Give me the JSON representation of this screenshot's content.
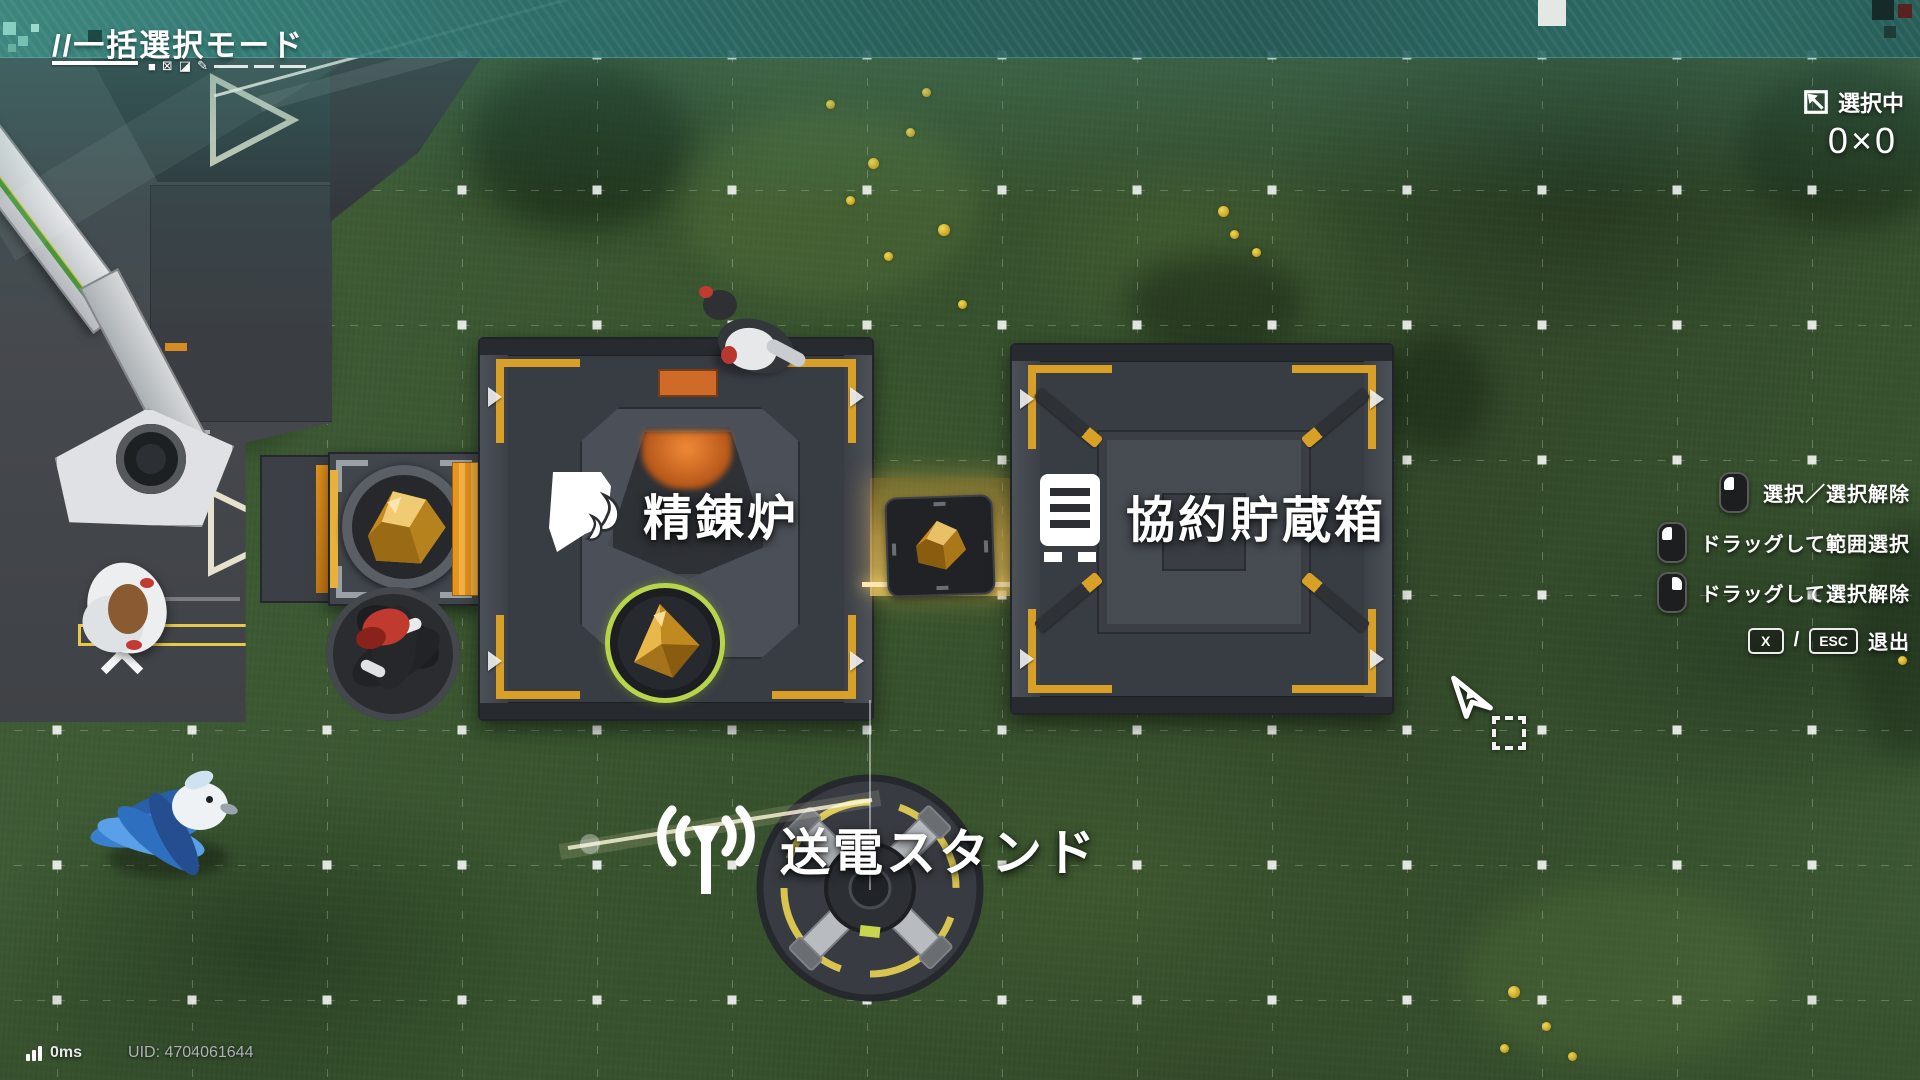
{
  "header": {
    "mode_title": "//一括選択モード"
  },
  "selection_status": {
    "label": "選択中",
    "count": "0×0"
  },
  "building_labels": {
    "refinery": "精錬炉",
    "storage": "協約貯蔵箱",
    "power_stand": "送電スタンド"
  },
  "hints": {
    "items": [
      {
        "device": "mouse-left",
        "label": "選択／選択解除"
      },
      {
        "device": "mouse-left-drag",
        "label": "ドラッグして範囲選択"
      },
      {
        "device": "mouse-right-drag",
        "label": "ドラッグして選択解除"
      }
    ],
    "exit": {
      "key1": "X",
      "separator": "/",
      "key2": "ESC",
      "label": "退出"
    }
  },
  "status_bar": {
    "ping": "0ms",
    "uid": "UID: 4704061644"
  },
  "icons": {
    "mode_filled_square": "■",
    "mode_checked_square": "⊠",
    "mode_half_square": "◪",
    "mode_edit_pencil": "✎",
    "selection_area_icon": "expand-arrow-square",
    "mouse_left_icon": "mouse-left-button",
    "mouse_right_icon": "mouse-right-button",
    "signal_icon": "signal-bars",
    "refinery_icon": "flame-sheet",
    "storage_icon": "ledger-box",
    "power_icon": "antenna-broadcast",
    "cursor_icon": "pointer-arrow"
  },
  "colors": {
    "banner_teal": "#2f7472",
    "accent_yellow": "#d9a028",
    "conveyor_orange": "#e8961e",
    "output_ring_green": "#b8d44a",
    "grass_green": "#3b5531"
  }
}
